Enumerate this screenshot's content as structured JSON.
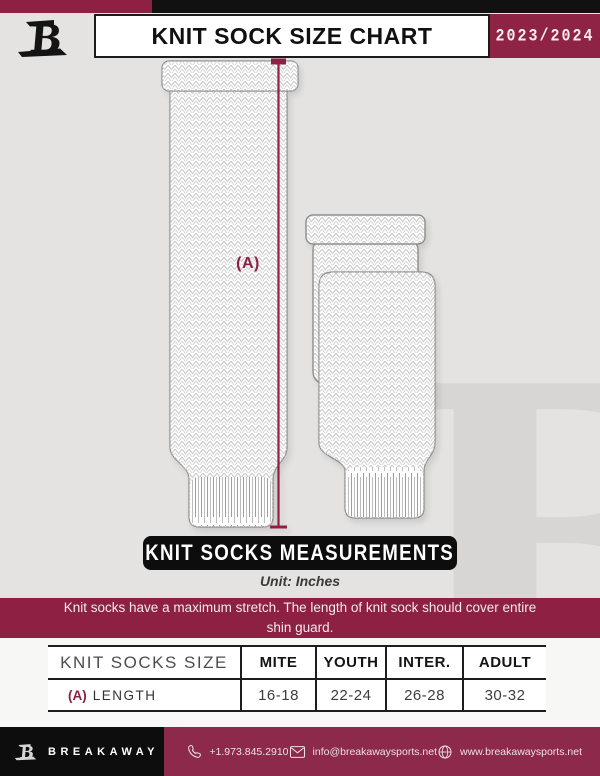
{
  "colors": {
    "maroon": "#8e2143",
    "black": "#0d0d0d",
    "background_gray": "#e4e3e1",
    "measure_line": "#8e2143"
  },
  "header": {
    "logo_icon": "breakaway-monogram-icon",
    "title": "KNIT SOCK SIZE CHART",
    "season": "2023/2024"
  },
  "diagram": {
    "measure_label": "(A)",
    "banner": "KNIT SOCKS MEASUREMENTS",
    "unit": "Unit: Inches"
  },
  "notice": {
    "text": "Knit socks have a maximum stretch. The length of knit sock should cover entire shin guard."
  },
  "table": {
    "header": [
      "KNIT SOCKS SIZE",
      "MITE",
      "YOUTH",
      "INTER.",
      "ADULT"
    ],
    "rows": [
      {
        "key": "(A)",
        "label": "LENGTH",
        "values": [
          "16-18",
          "22-24",
          "26-28",
          "30-32"
        ]
      }
    ]
  },
  "chart_data": {
    "type": "table",
    "title": "KNIT SOCK SIZE CHART",
    "unit": "Inches",
    "categories": [
      "MITE",
      "YOUTH",
      "INTER.",
      "ADULT"
    ],
    "series": [
      {
        "name": "(A) LENGTH",
        "values": [
          "16-18",
          "22-24",
          "26-28",
          "30-32"
        ]
      }
    ]
  },
  "footer": {
    "logo_icon": "breakaway-monogram-icon",
    "brand": "BREAKAWAY",
    "items": [
      {
        "icon": "phone-icon",
        "text": "+1.973.845.2910"
      },
      {
        "icon": "envelope-icon",
        "text": "info@breakawaysports.net"
      },
      {
        "icon": "globe-icon",
        "text": "www.breakawaysports.net"
      }
    ]
  }
}
